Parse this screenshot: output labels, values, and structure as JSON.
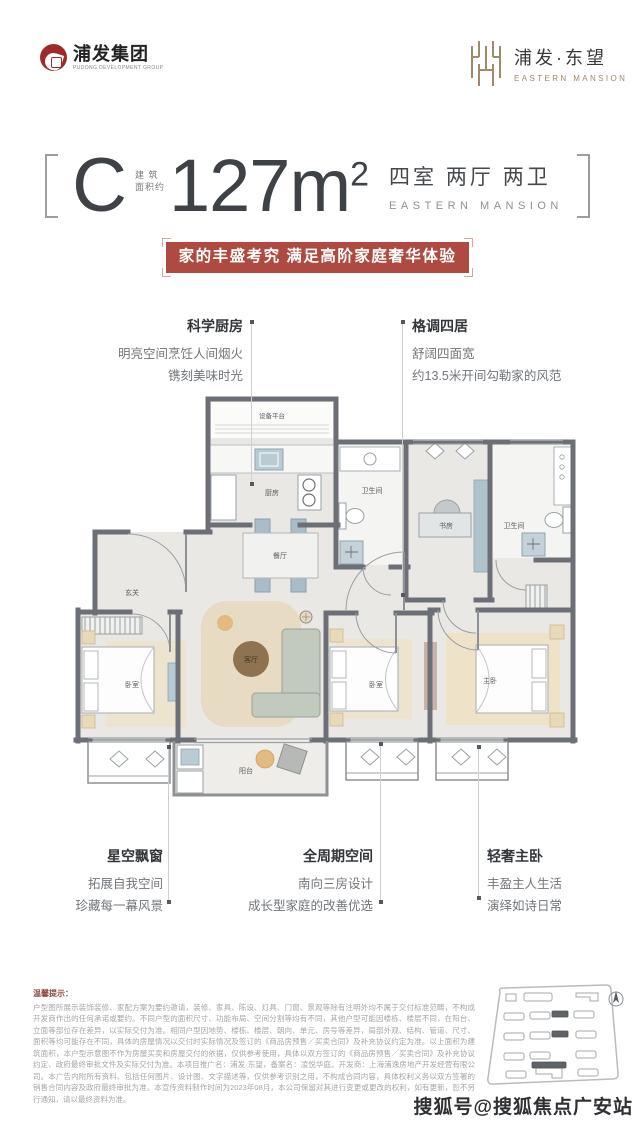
{
  "header": {
    "group_logo": {
      "name": "浦发集团",
      "sub": "PUDONG DEVELOPMENT GROUP"
    },
    "project_logo": {
      "name": "浦发·东望",
      "sub": "EASTERN MANSION"
    }
  },
  "headline": {
    "unit": "C",
    "area_note_line1": "建 筑",
    "area_note_line2": "面积约",
    "area": "127m",
    "area_sup": "2",
    "rooms": "四室 两厅 两卫",
    "rooms_sub": "EASTERN MANSION"
  },
  "banner": {
    "text": "家的丰盛考究 满足高阶家庭奢华体验",
    "bg_color": "#ae4a3f"
  },
  "callouts": {
    "kitchen": {
      "title": "科学厨房",
      "line1": "明亮空间烹饪人间烟火",
      "line2": "镌刻美味时光"
    },
    "four_rooms": {
      "title": "格调四居",
      "line1": "舒阔四面宽",
      "line2": "约13.5米开间勾勒家的风范"
    },
    "bay_window": {
      "title": "星空飘窗",
      "line1": "拓展自我空间",
      "line2": "珍藏每一幕风景"
    },
    "full_cycle": {
      "title": "全周期空间",
      "line1": "南向三房设计",
      "line2": "成长型家庭的改善优选"
    },
    "master": {
      "title": "轻奢主卧",
      "line1": "丰盈主人生活",
      "line2": "演绎如诗日常"
    }
  },
  "floorplan": {
    "equipment": "设备平台",
    "kitchen": "厨房",
    "dining": "餐厅",
    "foyer": "玄关",
    "bath1": "卫生间",
    "study": "书房",
    "bath2": "卫生间",
    "bedroom1": "卧室",
    "living": "客厅",
    "balcony": "阳台",
    "bedroom2": "卧室",
    "master": "主卧"
  },
  "disclaimer": {
    "label": "温馨提示：",
    "text": "户型图所展示装饰装修、家配方案为要约邀请，装修、家具、陈设、灯具、门窗、景观等除有注明外均不属于交付标准范畴，不构成开发商作出的任何承诺或要约。不同户型的面积尺寸、功能布局、空间分割等均有不同，其他户型可能因楼栋、楼层不同，在阳台、立面等部位存在差异，以实际交付为准。相同户型因地势、楼栋、楼层、朝向、单元、房号等差异，局部外观、结构、管道、尺寸、面积等均可能存在不同，具体的房屋情况以交付时实际情况及签订的《商品房预售／买卖合同》及补充协议约定为准。以上面积为建筑面积，本户型示意图不作为房屋买卖和房屋交付的依据，仅供参考使用，具体以双方签订的《商品房预售／买卖合同》及补充协议约定、政府最终审批文件及实际交付为准。本项目推广名：浦发·东望，备案名：凌悦华庭。开发商：上海浦逸房地产开发经营有限公司。本广告内附所有资料、包括任何图片、设计图、文字描述等，仅供参考识别之用，不构成合同内容，具体权利义务以双方签署的销售合同内容及政府最终审批为准。本宣传资料制作时间为2023年08月，本公司保留对其进行变更或更改的权利，如有更新，恕不另行通知，请以最终资料为准。"
  },
  "watermark": "搜狐号@搜狐焦点广安站"
}
